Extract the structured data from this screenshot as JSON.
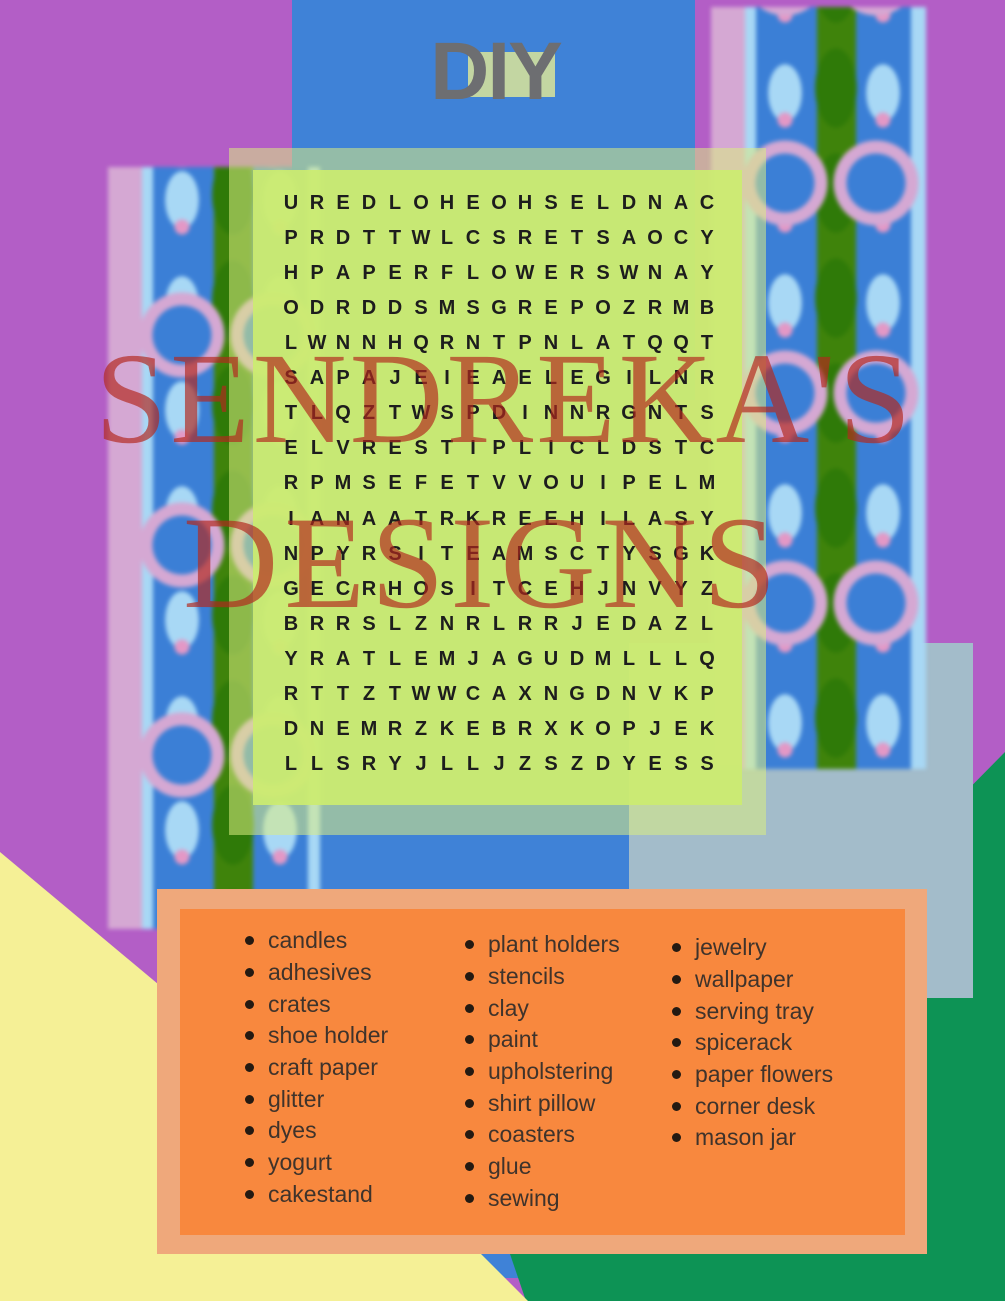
{
  "title": {
    "text": "DIY"
  },
  "watermark": {
    "line1": "SENDREKA'S",
    "line2": "DESIGNS"
  },
  "puzzle": {
    "rows": [
      "UREDLOHEOHSELDNAC",
      "PRDTTWLCSRETSAOCY",
      "HPAPERFLOWERSWNAY",
      "ODRDDSMSGREPOZRMB",
      "LWNNHQRNTPNLATQQT",
      "SAPAJEIEAELEGILNR",
      "TLQZTWSPDINNRGNTS",
      "ELVRESTIPLICLDSTC",
      "RPMSEFETVVOUIPELM",
      "IANAATRKREEHILASY",
      "NPYRSITEAMSCTYSGK",
      "GECRHOSITCEHJNVYZ",
      "BRRSLZNRLRRJEDAZL",
      "YRATLEMJAGUDMLLLQ",
      "RTTZTWWCAXNGDNVKP",
      "DNEMRZKEBRXKOPJEK",
      "LLSRYJLLJZSZDYESS"
    ]
  },
  "word_list": {
    "columns": [
      [
        "candles",
        "adhesives",
        "crates",
        "shoe holder",
        "craft paper",
        "glitter",
        "dyes",
        "yogurt",
        "cakestand"
      ],
      [
        "plant holders",
        "stencils",
        "clay",
        "paint",
        "upholstering",
        "shirt pillow",
        "coasters",
        "glue",
        "sewing"
      ],
      [
        "jewelry",
        "wallpaper",
        "serving tray",
        "spicerack",
        "paper flowers",
        "corner desk",
        "mason jar"
      ]
    ]
  },
  "colors": {
    "purple": "#b35ec6",
    "blue": "#3f82d7",
    "gray-blue": "#a3bcca",
    "green": "#0d9355",
    "yellow": "#f5f096",
    "orange-inner": "#f8883e",
    "orange-outer": "#efa87b",
    "lime-inner": "rgba(203,236,112,0.93)",
    "lime-outer": "rgba(218,236,130,0.55)",
    "watermark-red": "rgba(178,40,30,0.68)",
    "diy-gray": "#6d6e71",
    "diy-green": "#c3d6a2",
    "letter-ink": "#1d1d1d",
    "list-ink": "#3f332b",
    "pat-pink": "#d5a8d3",
    "pat-lblue": "#a8d8f5",
    "pat-blue": "#3b7fd6",
    "pat-green": "#3f830b",
    "pat-leaf": "#2f7a08",
    "pat-dot": "#e398c6"
  }
}
